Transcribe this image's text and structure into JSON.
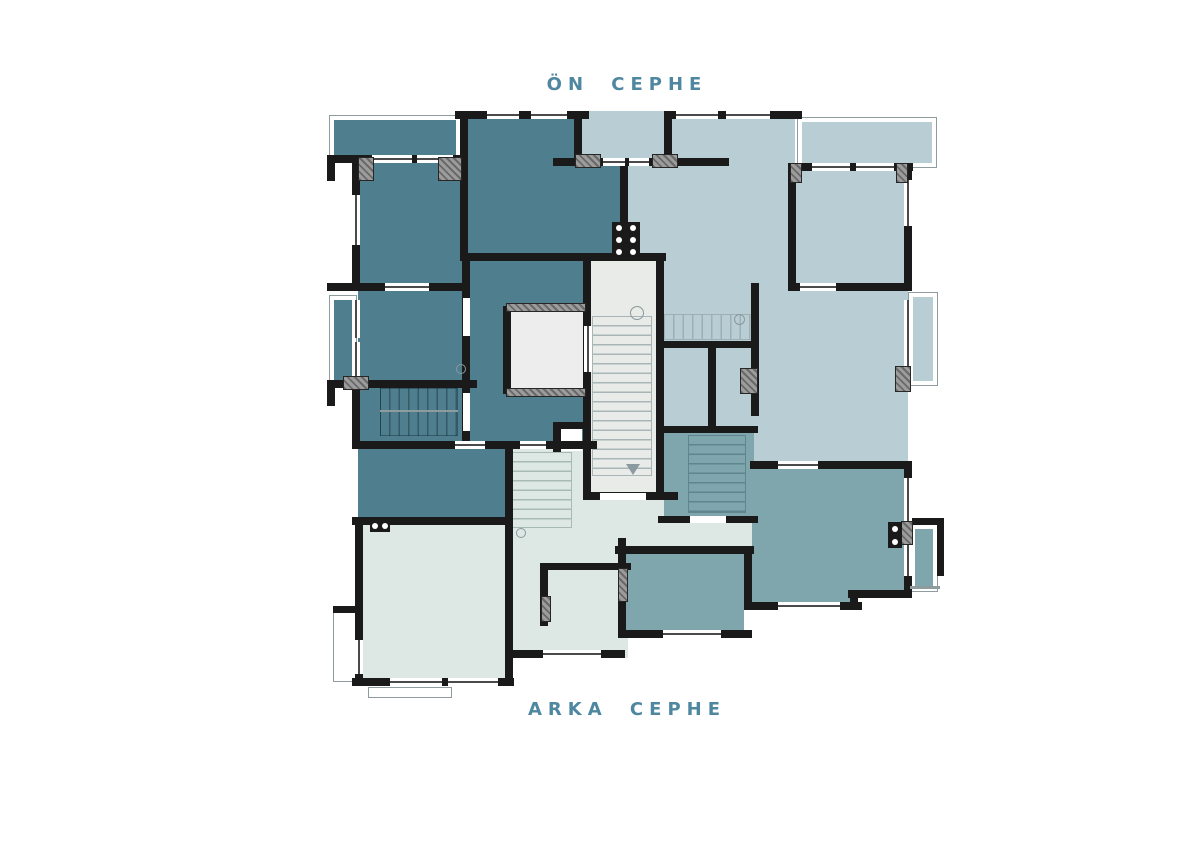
{
  "labels": {
    "front_facade": "ÖN CEPHE",
    "back_facade": "ARKA CEPHE"
  },
  "colors": {
    "label": "#4f87a0",
    "wall": "#1a1a1a",
    "dark": "#4f7f8e",
    "mid": "#7fa6ad",
    "light": "#b9ced4",
    "pale": "#dde8e4",
    "core": "#e9ebe9",
    "lift": "#ededed",
    "white": "#ffffff",
    "balcony_border": "#8e9b9f",
    "t_core": "#a9b4b6",
    "t_dark": "rgba(12,38,48,0.42)",
    "t_light": "#9cb0b6",
    "t_pale": "#a8bab6",
    "t_mid": "#5f868f"
  },
  "plan": {
    "label_top_pos": [
      427,
      74
    ],
    "label_bottom_pos": [
      427,
      699
    ],
    "rooms": [
      [
        "dark",
        358,
        160,
        110,
        132
      ],
      [
        "dark",
        460,
        111,
        167,
        150
      ],
      [
        "light",
        582,
        111,
        86,
        53
      ],
      [
        "dark",
        358,
        291,
        112,
        96
      ],
      [
        "dark",
        358,
        387,
        157,
        62
      ],
      [
        "dark",
        462,
        258,
        129,
        131
      ],
      [
        "dark",
        462,
        389,
        129,
        60
      ],
      [
        "dark",
        358,
        449,
        151,
        77
      ],
      [
        "light",
        627,
        111,
        168,
        150
      ],
      [
        "light",
        795,
        168,
        113,
        123
      ],
      [
        "light",
        662,
        258,
        246,
        209
      ],
      [
        "pale",
        510,
        449,
        118,
        209
      ],
      [
        "pale",
        360,
        524,
        150,
        158
      ],
      [
        "mid",
        622,
        467,
        286,
        130
      ],
      [
        "mid",
        622,
        555,
        236,
        53
      ],
      [
        "pale",
        587,
        497,
        165,
        52
      ],
      [
        "mid",
        622,
        553,
        126,
        80
      ],
      [
        "mid",
        664,
        433,
        90,
        85
      ],
      [
        "core",
        588,
        258,
        73,
        240
      ],
      [
        "lift",
        508,
        311,
        78,
        78
      ],
      [
        "white",
        556,
        429,
        26,
        22
      ]
    ],
    "balconies": [
      [
        "dark",
        329,
        115,
        132,
        46
      ],
      [
        "dark",
        329,
        295,
        28,
        90
      ],
      [
        "light",
        797,
        117,
        140,
        51
      ],
      [
        "light",
        908,
        292,
        30,
        94
      ],
      [
        "mid",
        910,
        524,
        28,
        68
      ],
      [
        "white",
        333,
        610,
        25,
        72
      ],
      [
        "white",
        368,
        687,
        84,
        11
      ]
    ],
    "stairs": [
      [
        592,
        316,
        60,
        160,
        "v",
        "t_core"
      ],
      [
        380,
        388,
        78,
        48,
        "h",
        "t_dark"
      ],
      [
        664,
        314,
        88,
        26,
        "h",
        "t_light"
      ],
      [
        512,
        452,
        60,
        76,
        "v",
        "t_pale"
      ],
      [
        688,
        435,
        58,
        78,
        "v",
        "t_mid"
      ]
    ],
    "walls": [
      [
        455,
        111,
        134,
        8
      ],
      [
        664,
        111,
        138,
        8
      ],
      [
        327,
        155,
        140,
        8
      ],
      [
        795,
        163,
        118,
        8
      ],
      [
        553,
        158,
        176,
        8
      ],
      [
        460,
        253,
        206,
        8
      ],
      [
        795,
        283,
        117,
        8
      ],
      [
        327,
        283,
        141,
        8
      ],
      [
        327,
        380,
        150,
        8
      ],
      [
        352,
        441,
        245,
        8
      ],
      [
        750,
        461,
        162,
        8
      ],
      [
        662,
        341,
        96,
        7
      ],
      [
        662,
        426,
        96,
        7
      ],
      [
        658,
        516,
        100,
        7
      ],
      [
        352,
        517,
        160,
        8
      ],
      [
        615,
        546,
        139,
        8
      ],
      [
        748,
        602,
        114,
        8
      ],
      [
        848,
        590,
        64,
        8
      ],
      [
        618,
        630,
        134,
        8
      ],
      [
        505,
        650,
        120,
        8
      ],
      [
        352,
        678,
        162,
        8
      ],
      [
        583,
        492,
        95,
        8
      ],
      [
        904,
        518,
        40,
        7
      ],
      [
        333,
        606,
        28,
        7
      ],
      [
        545,
        563,
        86,
        7
      ],
      [
        553,
        422,
        32,
        7
      ],
      [
        352,
        155,
        8,
        136
      ],
      [
        460,
        111,
        8,
        150
      ],
      [
        620,
        158,
        8,
        103
      ],
      [
        788,
        163,
        8,
        128
      ],
      [
        904,
        163,
        8,
        128
      ],
      [
        352,
        380,
        8,
        69
      ],
      [
        462,
        253,
        8,
        196
      ],
      [
        583,
        253,
        8,
        247
      ],
      [
        656,
        253,
        8,
        247
      ],
      [
        503,
        306,
        8,
        88
      ],
      [
        505,
        441,
        8,
        245
      ],
      [
        618,
        538,
        8,
        100
      ],
      [
        744,
        546,
        8,
        64
      ],
      [
        850,
        590,
        8,
        20
      ],
      [
        904,
        461,
        8,
        137
      ],
      [
        355,
        517,
        8,
        168
      ],
      [
        574,
        111,
        8,
        55
      ],
      [
        664,
        111,
        8,
        55
      ],
      [
        751,
        283,
        8,
        133
      ],
      [
        708,
        341,
        8,
        92
      ],
      [
        327,
        155,
        8,
        26
      ],
      [
        327,
        380,
        8,
        26
      ],
      [
        937,
        518,
        7,
        58
      ],
      [
        553,
        424,
        8,
        28
      ],
      [
        540,
        563,
        8,
        63
      ]
    ],
    "windows": [
      [
        487,
        111,
        32,
        8,
        "h"
      ],
      [
        531,
        111,
        36,
        8,
        "h"
      ],
      [
        676,
        111,
        42,
        8,
        "h"
      ],
      [
        726,
        111,
        44,
        8,
        "h"
      ],
      [
        372,
        155,
        40,
        8,
        "h"
      ],
      [
        417,
        155,
        36,
        8,
        "h"
      ],
      [
        812,
        163,
        38,
        8,
        "h"
      ],
      [
        856,
        163,
        38,
        8,
        "h"
      ],
      [
        603,
        158,
        22,
        8,
        "h"
      ],
      [
        629,
        158,
        20,
        8,
        "h"
      ],
      [
        385,
        283,
        44,
        8,
        "h"
      ],
      [
        800,
        283,
        36,
        8,
        "h"
      ],
      [
        352,
        195,
        8,
        50,
        "v"
      ],
      [
        352,
        300,
        8,
        38,
        "v"
      ],
      [
        352,
        342,
        8,
        36,
        "v"
      ],
      [
        904,
        180,
        8,
        46,
        "v"
      ],
      [
        904,
        300,
        8,
        80,
        "v"
      ],
      [
        904,
        478,
        8,
        48,
        "v"
      ],
      [
        904,
        532,
        8,
        44,
        "v"
      ],
      [
        778,
        461,
        40,
        8,
        "h"
      ],
      [
        778,
        602,
        62,
        8,
        "h"
      ],
      [
        663,
        630,
        58,
        8,
        "h"
      ],
      [
        543,
        650,
        58,
        8,
        "h"
      ],
      [
        390,
        678,
        52,
        8,
        "h"
      ],
      [
        448,
        678,
        50,
        8,
        "h"
      ],
      [
        455,
        441,
        30,
        8,
        "h"
      ],
      [
        520,
        441,
        26,
        8,
        "h"
      ],
      [
        584,
        326,
        8,
        46,
        "v"
      ],
      [
        355,
        640,
        8,
        34,
        "v"
      ]
    ],
    "gaps": [
      [
        463,
        298,
        7,
        38
      ],
      [
        463,
        393,
        7,
        38
      ],
      [
        600,
        493,
        46,
        7
      ],
      [
        690,
        516,
        36,
        7
      ],
      [
        744,
        610,
        8,
        20
      ]
    ],
    "doors": [
      [
        575,
        154,
        26,
        14
      ],
      [
        652,
        154,
        26,
        14
      ],
      [
        438,
        157,
        24,
        24
      ],
      [
        358,
        157,
        16,
        24
      ],
      [
        506,
        303,
        80,
        9
      ],
      [
        506,
        388,
        80,
        9
      ],
      [
        343,
        376,
        26,
        14
      ],
      [
        740,
        368,
        18,
        26
      ],
      [
        895,
        366,
        16,
        26
      ],
      [
        901,
        521,
        12,
        24
      ],
      [
        618,
        568,
        10,
        34
      ],
      [
        541,
        596,
        10,
        26
      ],
      [
        790,
        163,
        12,
        20
      ],
      [
        896,
        163,
        12,
        20
      ]
    ],
    "dot_blocks": [
      [
        612,
        222,
        28,
        36,
        2,
        3
      ],
      [
        888,
        522,
        14,
        26,
        1,
        2
      ],
      [
        370,
        520,
        20,
        12,
        2,
        1
      ]
    ],
    "circles": [
      [
        630,
        306,
        14
      ],
      [
        734,
        314,
        11
      ],
      [
        516,
        528,
        10
      ],
      [
        456,
        364,
        10
      ]
    ],
    "triangles": [
      [
        626,
        464
      ]
    ],
    "lines": [
      [
        910,
        586,
        30,
        3
      ],
      [
        380,
        410,
        78,
        2
      ]
    ]
  }
}
